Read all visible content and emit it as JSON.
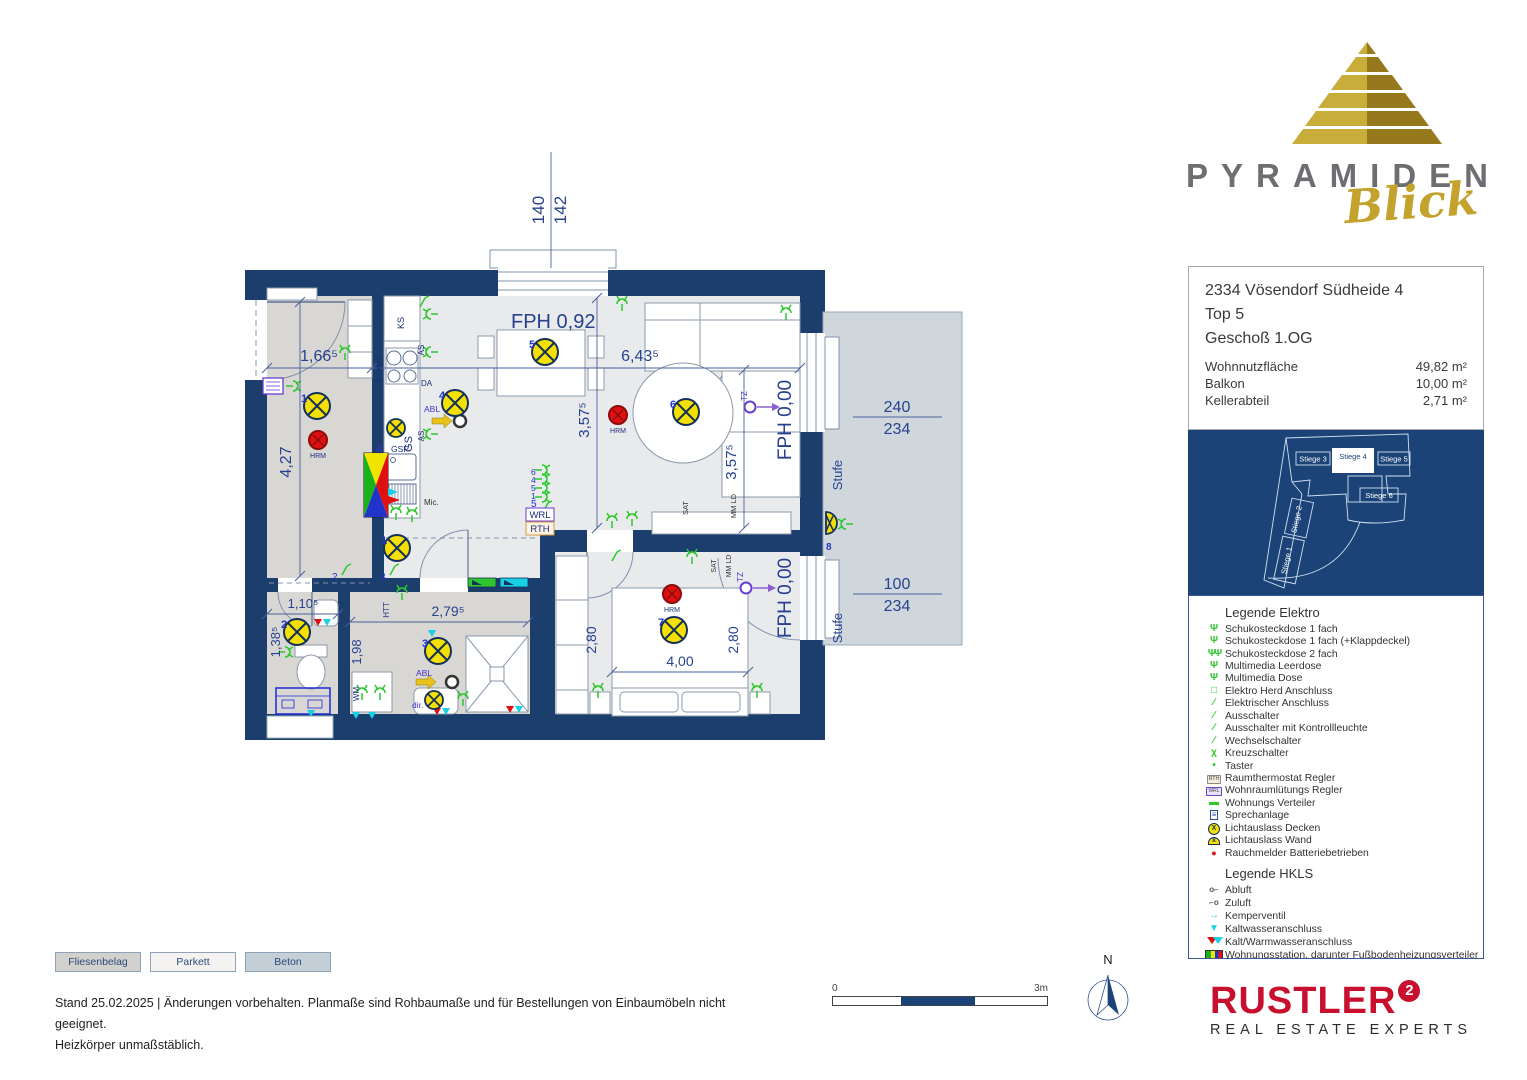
{
  "branding": {
    "word": "PYRAMIDEN",
    "script": "Blick"
  },
  "info": {
    "title1": "2334 Vösendorf Südheide 4",
    "title2": "Top 5",
    "title3": "Geschoß 1.OG",
    "rows": [
      {
        "label": "Wohnnutzfläche",
        "value": "49,82 m²"
      },
      {
        "label": "Balkon",
        "value": "10,00 m²"
      },
      {
        "label": "Kellerabteil",
        "value": "2,71 m²"
      }
    ]
  },
  "site_map": {
    "stiege1": "Stiege 1",
    "stiege2": "Stiege 2",
    "stiege3": "Stiege 3",
    "stiege4": "Stiege 4",
    "stiege5": "Stiege 5",
    "stiege6": "Stiege 6"
  },
  "legend_elektro": {
    "title": "Legende Elektro",
    "items": [
      {
        "icon": "schuko-1-icon",
        "glyph": "Ψ",
        "label": "Schukosteckdose 1 fach"
      },
      {
        "icon": "schuko-1-klappdeckel-icon",
        "glyph": "Ψ",
        "label": "Schukosteckdose 1 fach (+Klappdeckel)"
      },
      {
        "icon": "schuko-2-icon",
        "glyph": "ΨΨ",
        "label": "Schukosteckdose 2 fach"
      },
      {
        "icon": "multimedia-leerdose-icon",
        "glyph": "Ψ",
        "label": "Multimedia Leerdose"
      },
      {
        "icon": "multimedia-dose-icon",
        "glyph": "Ψ",
        "label": "Multimedia Dose"
      },
      {
        "icon": "herd-anschluss-icon",
        "glyph": "□",
        "label": "Elektro Herd Anschluss"
      },
      {
        "icon": "elektrischer-anschluss-icon",
        "glyph": "∕",
        "label": "Elektrischer Anschluss"
      },
      {
        "icon": "ausschalter-icon",
        "glyph": "∕",
        "label": "Ausschalter"
      },
      {
        "icon": "ausschalter-kontrollleuchte-icon",
        "glyph": "∕",
        "label": "Ausschalter mit Kontrollleuchte"
      },
      {
        "icon": "wechselschalter-icon",
        "glyph": "∕",
        "label": "Wechselschalter"
      },
      {
        "icon": "kreuzschalter-icon",
        "glyph": "χ",
        "label": "Kreuzschalter"
      },
      {
        "icon": "taster-icon",
        "glyph": "•",
        "label": "Taster"
      },
      {
        "icon": "raumthermostat-icon",
        "glyph": "RTH",
        "label": "Raumthermostat Regler"
      },
      {
        "icon": "wohnraumlueftung-regler-icon",
        "glyph": "WRL",
        "label": "Wohnraumlütungs Regler"
      },
      {
        "icon": "wohnungs-verteiler-icon",
        "glyph": "▬",
        "label": "Wohnungs Verteiler"
      },
      {
        "icon": "sprechanlage-icon",
        "glyph": "≡",
        "label": "Sprechanlage"
      },
      {
        "icon": "lichtauslass-decken-icon",
        "glyph": "X",
        "label": "Lichtauslass Decken"
      },
      {
        "icon": "lichtauslass-wand-icon",
        "glyph": "x",
        "label": "Lichtauslass Wand"
      },
      {
        "icon": "rauchmelder-icon",
        "glyph": "●",
        "label": "Rauchmelder Batteriebetrieben"
      }
    ]
  },
  "legend_hkls": {
    "title": "Legende HKLS",
    "items": [
      {
        "icon": "abluft-icon",
        "glyph": "o⌐",
        "label": "Abluft"
      },
      {
        "icon": "zuluft-icon",
        "glyph": "⌐o",
        "label": "Zuluft"
      },
      {
        "icon": "kemperventil-icon",
        "glyph": "→",
        "label": "Kemperventil"
      },
      {
        "icon": "kaltwasser-icon",
        "glyph": "▼",
        "label": "Kaltwasseranschluss"
      },
      {
        "icon": "kalt-warmwasser-icon",
        "glyph": "",
        "label": "Kalt/Warmwasseranschluss"
      },
      {
        "icon": "wohnungsstation-icon",
        "glyph": "",
        "label": "Wohnungsstation, darunter Fußbodenheizungsverteiler"
      },
      {
        "icon": "wohnraumlueftung-icon",
        "glyph": "",
        "label": "Wohnraumlüftung"
      }
    ]
  },
  "flooring": {
    "fliesen": "Fliesenbelag",
    "parkett": "Parkett",
    "beton": "Beton"
  },
  "footer": {
    "line1": "Stand 25.02.2025 | Änderungen vorbehalten. Planmaße sind Rohbaumaße und für Bestellungen von Einbaumöbeln nicht geeignet.",
    "line2": "Heizkörper unmaßstäblich."
  },
  "scalebar": {
    "start": "0",
    "end": "3m"
  },
  "compass": {
    "n": "N"
  },
  "rustler": {
    "name": "RUSTLER",
    "sup": "2",
    "tagline": "REAL ESTATE EXPERTS"
  },
  "plan": {
    "dim140": "140",
    "dim142": "142",
    "fph_window": "FPH 0,92",
    "hall_w": "1,66⁵",
    "hall_h": "4,27",
    "living_w": "6,43⁵",
    "living_h_left": "3,57⁵",
    "living_h_right": "3,57⁵",
    "fph_top": "FPH 0,00",
    "fph_bottom": "FPH 0,00",
    "balc_top_a": "240",
    "balc_top_b": "234",
    "balc_bot_a": "100",
    "balc_bot_b": "234",
    "stufe_top": "Stufe",
    "stufe_bot": "Stufe",
    "wc_w": "1,10⁵",
    "wc_h": "1,38⁵",
    "bath_w": "2,79⁵",
    "bath_h": "1,98",
    "bed_h_left": "2,80",
    "bed_h_right": "2,80",
    "bed_w": "4,00",
    "wrl": "WRL",
    "rth": "RTH",
    "hrm_hall": "HRM",
    "hrm_living": "HRM",
    "hrm_bed": "HRM",
    "ks": "KS",
    "as1": "AS",
    "as2": "AS",
    "da": "DA",
    "eherd": "E-Herd",
    "gs": "GS",
    "dir_kitchen": "dir.",
    "gsp": "GSP",
    "mic": "Mic.",
    "abl_kitchen": "ABL",
    "abl_bath": "ABL",
    "dir_bath": "dir.",
    "htt": "HTT",
    "wm": "WM",
    "sat_living": "SAT",
    "mmld_living": "MM LD",
    "sat_bed": "SAT",
    "mmld_bed": "MM LD",
    "tz_living": "TZ",
    "tz_bed": "TZ",
    "n1_hall": "1",
    "n1_corr": "1",
    "n2_wc": "2",
    "n3_bath": "3",
    "n4": "4",
    "n5": "5",
    "n6": "6",
    "n7": "7",
    "n8": "8",
    "sw2": "2",
    "sw3": "3",
    "sw5": "5",
    "g6": "6",
    "g4": "4",
    "g5": "5",
    "g1": "1"
  }
}
